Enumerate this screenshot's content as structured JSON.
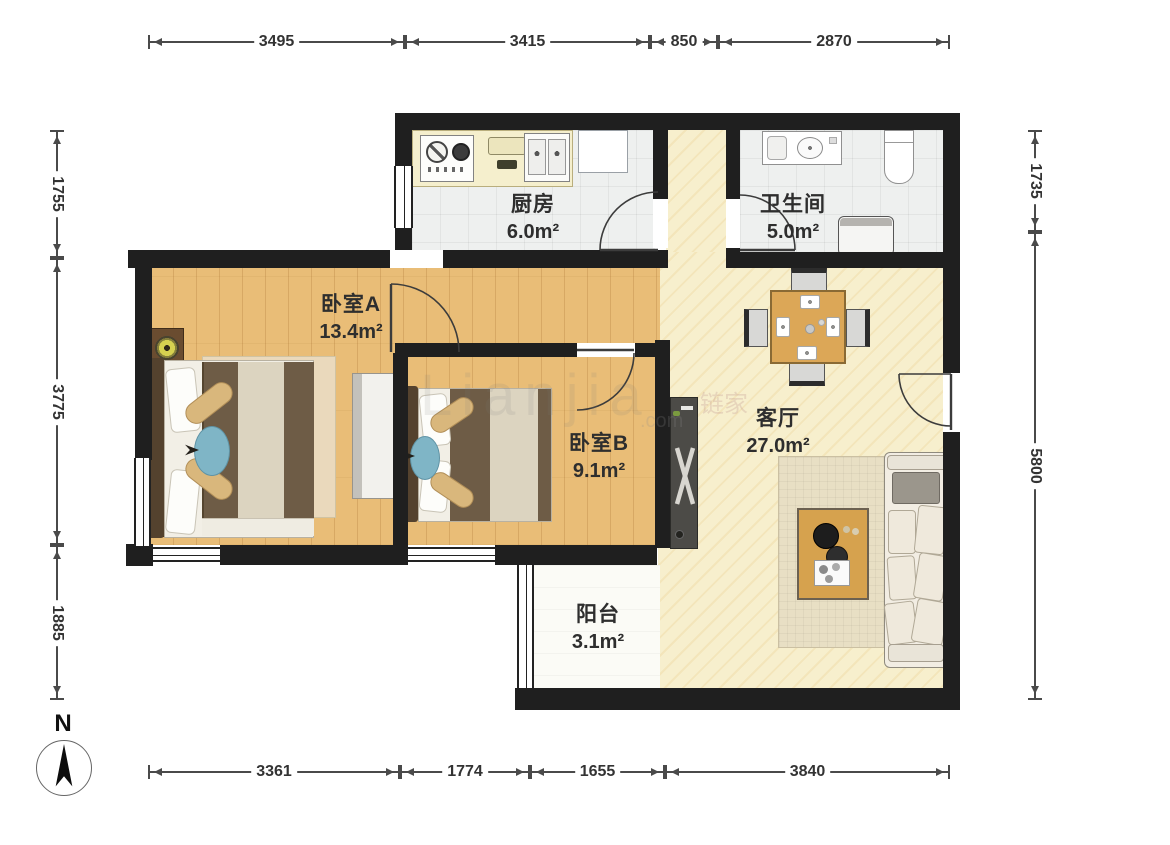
{
  "rooms": {
    "kitchen": {
      "name": "厨房",
      "area": "6.0m²"
    },
    "bathroom": {
      "name": "卫生间",
      "area": "5.0m²"
    },
    "bedroomA": {
      "name": "卧室A",
      "area": "13.4m²"
    },
    "bedroomB": {
      "name": "卧室B",
      "area": "9.1m²"
    },
    "living": {
      "name": "客厅",
      "area": "27.0m²"
    },
    "balcony": {
      "name": "阳台",
      "area": "3.1m²"
    }
  },
  "dims": {
    "top": [
      "3495",
      "3415",
      "850",
      "2870"
    ],
    "bottom": [
      "3361",
      "1774",
      "1655",
      "3840"
    ],
    "left": [
      "1755",
      "3775",
      "1885"
    ],
    "right": [
      "1735",
      "5800"
    ]
  },
  "compass": {
    "label": "N"
  },
  "watermark": {
    "latin": "Lianjia",
    "cn": "链家",
    "com": ".com"
  },
  "colors": {
    "wall": "#1f1f1f",
    "wood_floor": "#e9bd77",
    "marble_floor": "#f7efcd",
    "tile_floor": "#eef0ef"
  }
}
